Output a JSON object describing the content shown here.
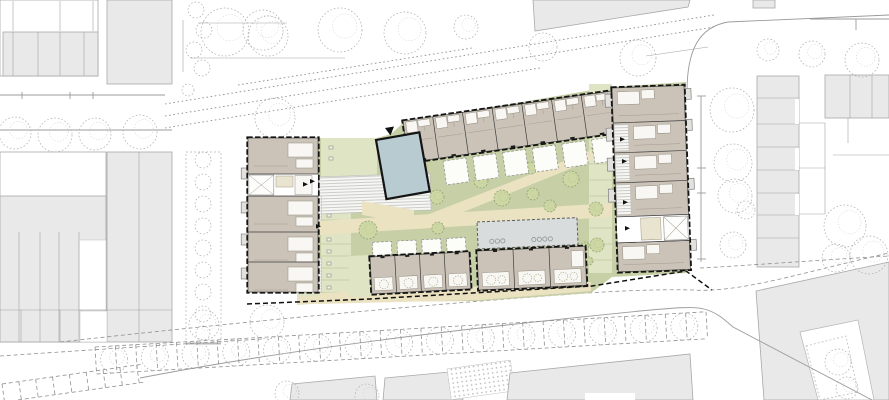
{
  "meta": {
    "type": "architectural-site-plan",
    "canvas": {
      "width": 889,
      "height": 400
    },
    "visible_text": []
  },
  "palette": {
    "ctx": "#e9e9e9",
    "ctx_stroke": "#a8a8a8",
    "unit": "#cbc3b8",
    "courtyard": "#c6cfa6",
    "garden": "#dee4c4",
    "path": "#ebe2c1",
    "blue": "#b7cbd0",
    "canopy": "#d8dcdc",
    "tree": "#ccd7a3",
    "tree_stroke": "#93a272",
    "beige": "#e9e4cf"
  },
  "site": {
    "blocks": [
      {
        "id": "north-terrace-row",
        "type": "rowN",
        "x": 403,
        "y": 121,
        "angle": -8.2,
        "length": 210,
        "height": 42,
        "units": 7,
        "terraces": 6
      },
      {
        "id": "west-apartment-block",
        "type": "blockW",
        "x": 248,
        "y": 138,
        "angle": 0,
        "width": 70,
        "height": 154
      },
      {
        "id": "east-apartment-block",
        "type": "blockE",
        "x": 612,
        "y": 88,
        "angle": -2,
        "width": 72,
        "height": 184
      },
      {
        "id": "south-row-west",
        "type": "rowS1",
        "x": 370,
        "y": 257,
        "angle": -3,
        "length": 99,
        "height": 37,
        "units": 4
      },
      {
        "id": "canopy-bike-shelter",
        "type": "canopy",
        "x": 477,
        "y": 222,
        "angle": -2.5,
        "length": 100,
        "height": 27
      },
      {
        "id": "south-row-east",
        "type": "rowS2",
        "x": 477,
        "y": 251,
        "angle": -2.5,
        "length": 108,
        "height": 39,
        "units": 3
      },
      {
        "id": "common-building",
        "type": "blue",
        "x": 376,
        "y": 140,
        "angle": -10,
        "width": 44,
        "height": 60
      }
    ],
    "courtyard_trees": [
      [
        368,
        230,
        9
      ],
      [
        437,
        197,
        7
      ],
      [
        438,
        228,
        6
      ],
      [
        471,
        145,
        5
      ],
      [
        481,
        181,
        7
      ],
      [
        502,
        198,
        8
      ],
      [
        531,
        168,
        6
      ],
      [
        533,
        194,
        6
      ],
      [
        550,
        206,
        6
      ],
      [
        571,
        179,
        8
      ],
      [
        600,
        149,
        8
      ],
      [
        596,
        209,
        7
      ],
      [
        597,
        245,
        7
      ],
      [
        589,
        261,
        4
      ],
      [
        585,
        246,
        4
      ]
    ],
    "garden_strips": [
      {
        "x": 321,
        "y": 196,
        "w": 30,
        "h": 96,
        "div_step": 12,
        "icons": {
          "x": 327,
          "y0": 202,
          "step": 12,
          "n": 8
        }
      },
      {
        "x": 321,
        "y": 138,
        "w": 56,
        "h": 39,
        "icons": {
          "x": 329,
          "y0": 146,
          "step": 11,
          "n": 2
        }
      },
      {
        "x": 589,
        "y": 84,
        "w": 23,
        "h": 189,
        "div_step": 16
      },
      {
        "x": 297,
        "y": 280,
        "w": 21,
        "h": 22
      }
    ],
    "hatched_walkways": [
      [
        318,
        177,
        112,
        37,
        -2
      ],
      [
        311.5,
        196,
        10,
        36,
        0
      ],
      [
        311.5,
        258,
        10,
        34,
        0
      ]
    ],
    "entrance_arrows": [
      [
        303,
        182
      ],
      [
        310,
        179
      ],
      [
        316,
        224
      ],
      [
        620,
        137
      ],
      [
        622,
        159
      ],
      [
        623,
        200
      ],
      [
        625,
        226
      ]
    ],
    "entrance_marker": [
      [
        385,
        128
      ],
      [
        394,
        126.5
      ],
      [
        390.5,
        135.5
      ]
    ],
    "boundary_dash": "247,304 370,299 592,286 686,271 712,290"
  },
  "context": {
    "trees": [
      [
        15,
        133,
        16
      ],
      [
        55,
        135,
        17
      ],
      [
        95,
        134,
        16
      ],
      [
        140,
        132,
        17
      ],
      [
        225,
        32,
        24
      ],
      [
        268,
        36,
        20
      ],
      [
        340,
        30,
        22
      ],
      [
        405,
        33,
        21
      ],
      [
        466,
        27,
        12
      ],
      [
        543,
        47,
        14
      ],
      [
        638,
        58,
        18
      ],
      [
        768,
        50,
        11
      ],
      [
        812,
        54,
        13
      ],
      [
        862,
        60,
        17
      ],
      [
        263,
        30,
        20
      ],
      [
        275,
        118,
        20
      ],
      [
        732,
        110,
        22
      ],
      [
        733,
        163,
        19
      ],
      [
        735,
        196,
        17
      ],
      [
        733,
        245,
        13
      ],
      [
        746,
        210,
        9
      ],
      [
        845,
        226,
        21
      ],
      [
        869,
        255,
        19
      ],
      [
        836,
        258,
        14
      ],
      [
        204,
        325,
        15
      ],
      [
        267,
        322,
        17
      ],
      [
        287,
        393,
        12
      ],
      [
        367,
        396,
        12
      ],
      [
        838,
        362,
        13
      ],
      [
        847,
        388,
        11
      ]
    ],
    "bushes": [
      [
        203,
        160,
        8
      ],
      [
        203,
        182,
        8
      ],
      [
        203,
        204,
        8
      ],
      [
        203,
        226,
        8
      ],
      [
        203,
        248,
        8
      ],
      [
        203,
        270,
        8
      ],
      [
        203,
        292,
        8
      ],
      [
        203,
        314,
        8
      ],
      [
        203,
        333,
        7
      ],
      [
        196,
        10,
        8
      ],
      [
        204,
        30,
        8
      ],
      [
        194,
        50,
        8
      ],
      [
        202,
        68,
        8
      ],
      [
        188,
        90,
        6
      ]
    ],
    "parking_strips": [
      {
        "name": "parking-row-south",
        "x": 95,
        "y": 347,
        "angle": -3.3,
        "length": 612,
        "width": 27,
        "div_step": 20.4,
        "tree_step": 40.8,
        "tree_r": 13.5
      },
      {
        "name": "parking-row-corner",
        "x": 2,
        "y": 384,
        "angle": -8,
        "length": 140,
        "width": 18,
        "div_step": 17
      }
    ]
  }
}
